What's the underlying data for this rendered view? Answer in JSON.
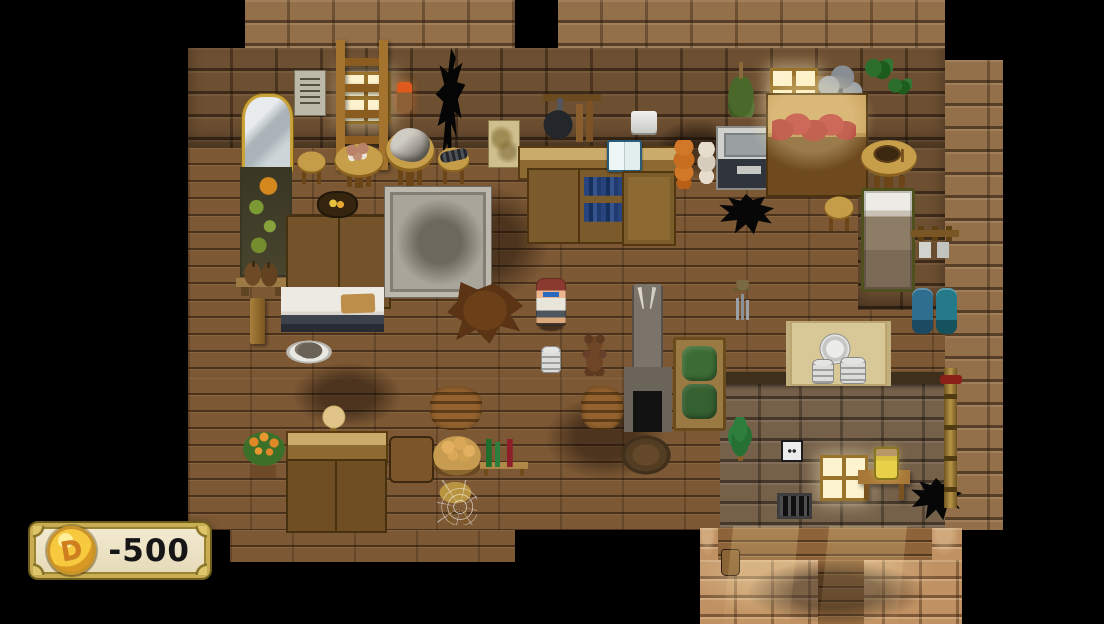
{
  "hud": {
    "gold_counter": {
      "value": "-500",
      "coin_icon": "gold-coin-icon",
      "coin_symbol": "D",
      "colors": {
        "panel": "#ece3c6",
        "border_gold": "#c9ad52",
        "border_dark": "#6e5e1c",
        "coin": "#f6c93e",
        "text": "#161616"
      }
    }
  },
  "scene": {
    "background": "#000000",
    "palette": {
      "wall_brick": "#93704a",
      "wall_face": "#6d4f31",
      "stone_wall": "#75604a",
      "bright_brick": "#c09162",
      "floor_wood": "#7c5834",
      "walkway_wood": "#8d6339"
    },
    "regions": [
      {
        "name": "wall-top-left",
        "kind": "wall",
        "x": 245,
        "y": 0,
        "w": 270,
        "h": 50
      },
      {
        "name": "wall-top-right",
        "kind": "wall",
        "x": 558,
        "y": 0,
        "w": 387,
        "h": 50
      },
      {
        "name": "wall-face-band",
        "kind": "wallface",
        "x": 188,
        "y": 48,
        "w": 757,
        "h": 100
      },
      {
        "name": "wall-right-column",
        "kind": "wall",
        "x": 945,
        "y": 60,
        "w": 58,
        "h": 470
      },
      {
        "name": "floor-main",
        "kind": "floor",
        "x": 188,
        "y": 148,
        "w": 757,
        "h": 230
      },
      {
        "name": "floor-lower-left",
        "kind": "floor",
        "x": 188,
        "y": 378,
        "w": 532,
        "h": 152
      },
      {
        "name": "floor-bottom-strip",
        "kind": "floor",
        "x": 230,
        "y": 530,
        "w": 285,
        "h": 32
      },
      {
        "name": "bed-nook-wall",
        "kind": "wallface",
        "x": 858,
        "y": 148,
        "w": 87,
        "h": 162
      },
      {
        "name": "inner-room-wall",
        "kind": "stonewall",
        "x": 720,
        "y": 378,
        "w": 225,
        "h": 152
      },
      {
        "name": "inner-room-roof-edge",
        "kind": "roofedge",
        "x": 714,
        "y": 372,
        "w": 236,
        "h": 12
      },
      {
        "name": "walkway-horizontal",
        "kind": "walkway",
        "x": 718,
        "y": 528,
        "w": 214,
        "h": 32
      },
      {
        "name": "bright-floor",
        "kind": "bright",
        "x": 700,
        "y": 560,
        "w": 262,
        "h": 64
      },
      {
        "name": "bright-floor-right",
        "kind": "bright",
        "x": 932,
        "y": 528,
        "w": 30,
        "h": 32
      },
      {
        "name": "bright-floor-left",
        "kind": "bright",
        "x": 700,
        "y": 528,
        "w": 18,
        "h": 32
      },
      {
        "name": "walkway-vertical",
        "kind": "walkway",
        "x": 818,
        "y": 560,
        "w": 46,
        "h": 64
      }
    ],
    "objects": [
      {
        "name": "floor-stain-1",
        "kind": "stain",
        "x": 420,
        "y": 185,
        "w": 130,
        "h": 115
      },
      {
        "name": "floor-stain-2",
        "kind": "stain",
        "x": 545,
        "y": 395,
        "w": 120,
        "h": 85
      },
      {
        "name": "floor-stain-3",
        "kind": "stain",
        "x": 292,
        "y": 362,
        "w": 110,
        "h": 66
      },
      {
        "name": "floor-stain-4",
        "kind": "stain",
        "x": 745,
        "y": 560,
        "w": 180,
        "h": 64
      },
      {
        "name": "floor-stain-5",
        "kind": "stain",
        "x": 655,
        "y": 118,
        "w": 85,
        "h": 62
      },
      {
        "name": "mirror",
        "kind": "mirror",
        "x": 242,
        "y": 94,
        "w": 45,
        "h": 74
      },
      {
        "name": "notice-poster",
        "kind": "poster",
        "x": 294,
        "y": 70,
        "w": 30,
        "h": 44
      },
      {
        "name": "lit-window-left",
        "kind": "window",
        "x": 341,
        "y": 72,
        "w": 44,
        "h": 46
      },
      {
        "name": "ladder",
        "kind": "ladder",
        "x": 336,
        "y": 40,
        "w": 52,
        "h": 130
      },
      {
        "name": "wall-torch",
        "kind": "torch",
        "x": 397,
        "y": 82,
        "w": 15,
        "h": 30
      },
      {
        "name": "burnt-wall-crack",
        "kind": "crack",
        "x": 428,
        "y": 48,
        "w": 48,
        "h": 122
      },
      {
        "name": "stained-poster",
        "kind": "poster2",
        "x": 488,
        "y": 120,
        "w": 30,
        "h": 46
      },
      {
        "name": "pan-rack",
        "kind": "panrack",
        "x": 543,
        "y": 94,
        "w": 58,
        "h": 48
      },
      {
        "name": "paper-roll-holder",
        "kind": "roll",
        "x": 631,
        "y": 111,
        "w": 26,
        "h": 22
      },
      {
        "name": "dried-herb-bundle",
        "kind": "herbs",
        "x": 727,
        "y": 62,
        "w": 28,
        "h": 55
      },
      {
        "name": "lit-window-right",
        "kind": "window",
        "x": 770,
        "y": 68,
        "w": 42,
        "h": 34
      },
      {
        "name": "coal-pile",
        "kind": "coal",
        "x": 815,
        "y": 62,
        "w": 50,
        "h": 54
      },
      {
        "name": "vine-leaf-upper",
        "kind": "leaf",
        "x": 865,
        "y": 58,
        "w": 28,
        "h": 22
      },
      {
        "name": "vine-leaf-lower",
        "kind": "leaf",
        "x": 888,
        "y": 78,
        "w": 24,
        "h": 17
      },
      {
        "name": "fruit-panel",
        "kind": "mossy",
        "x": 240,
        "y": 167,
        "w": 48,
        "h": 106
      },
      {
        "name": "sack-shelf",
        "kind": "sackshelf",
        "x": 236,
        "y": 254,
        "w": 52,
        "h": 42
      },
      {
        "name": "wood-post",
        "kind": "post",
        "x": 250,
        "y": 298,
        "w": 15,
        "h": 46
      },
      {
        "name": "stool-left",
        "kind": "stool",
        "x": 295,
        "y": 150,
        "w": 33,
        "h": 34
      },
      {
        "name": "mushroom-table",
        "kind": "tablemush",
        "x": 334,
        "y": 142,
        "w": 50,
        "h": 46
      },
      {
        "name": "rock-table",
        "kind": "table",
        "x": 385,
        "y": 130,
        "w": 50,
        "h": 57
      },
      {
        "name": "table-rock",
        "kind": "rock",
        "x": 390,
        "y": 128,
        "w": 40,
        "h": 34
      },
      {
        "name": "centipede-stool",
        "kind": "stool",
        "x": 435,
        "y": 146,
        "w": 37,
        "h": 38
      },
      {
        "name": "centipede",
        "kind": "bug",
        "x": 440,
        "y": 150,
        "w": 28,
        "h": 11
      },
      {
        "name": "green-dish-cupboard",
        "kind": "cupgreen",
        "x": 286,
        "y": 215,
        "w": 51,
        "h": 90
      },
      {
        "name": "bread-cupboard",
        "kind": "cupbread",
        "x": 338,
        "y": 215,
        "w": 49,
        "h": 90
      },
      {
        "name": "fruit-plaque",
        "kind": "plaque",
        "x": 317,
        "y": 191,
        "w": 37,
        "h": 23
      },
      {
        "name": "stone-rug",
        "kind": "stonerug",
        "x": 385,
        "y": 187,
        "w": 96,
        "h": 100
      },
      {
        "name": "back-counter",
        "kind": "countertan",
        "x": 518,
        "y": 146,
        "w": 165,
        "h": 30
      },
      {
        "name": "canned-goods-shelf",
        "kind": "cans",
        "x": 527,
        "y": 168,
        "w": 56,
        "h": 72
      },
      {
        "name": "bookshelf",
        "kind": "books",
        "x": 578,
        "y": 168,
        "w": 55,
        "h": 72
      },
      {
        "name": "display-book",
        "kind": "openbook",
        "x": 607,
        "y": 140,
        "w": 31,
        "h": 28
      },
      {
        "name": "wardrobe",
        "kind": "wardrobe",
        "x": 622,
        "y": 171,
        "w": 50,
        "h": 71
      },
      {
        "name": "onion-string",
        "kind": "onions",
        "x": 672,
        "y": 140,
        "w": 24,
        "h": 49
      },
      {
        "name": "garlic-string",
        "kind": "garlic",
        "x": 696,
        "y": 142,
        "w": 21,
        "h": 44
      },
      {
        "name": "sink-unit",
        "kind": "sink",
        "x": 716,
        "y": 126,
        "w": 62,
        "h": 60
      },
      {
        "name": "sausage-counter",
        "kind": "counterwood",
        "x": 766,
        "y": 93,
        "w": 98,
        "h": 100
      },
      {
        "name": "sausage-links",
        "kind": "sausage",
        "x": 772,
        "y": 112,
        "w": 84,
        "h": 32
      },
      {
        "name": "floor-hole-kitchen",
        "kind": "hole",
        "x": 718,
        "y": 194,
        "w": 56,
        "h": 42
      },
      {
        "name": "bowl-table",
        "kind": "tablebowl",
        "x": 860,
        "y": 139,
        "w": 58,
        "h": 50
      },
      {
        "name": "bedroom-stool",
        "kind": "stool",
        "x": 822,
        "y": 195,
        "w": 34,
        "h": 36
      },
      {
        "name": "bed",
        "kind": "bed",
        "x": 861,
        "y": 188,
        "w": 48,
        "h": 98
      },
      {
        "name": "mug-rack",
        "kind": "mugrack",
        "x": 911,
        "y": 226,
        "w": 48,
        "h": 35
      },
      {
        "name": "bedroll-pair",
        "kind": "bluerolls",
        "x": 911,
        "y": 288,
        "w": 48,
        "h": 46
      },
      {
        "name": "bear-pelt-rug",
        "kind": "pelt",
        "x": 447,
        "y": 282,
        "w": 76,
        "h": 63
      },
      {
        "name": "white-counter",
        "kind": "whitecounter",
        "x": 281,
        "y": 287,
        "w": 103,
        "h": 45
      },
      {
        "name": "cutting-board",
        "kind": "cutboard",
        "x": 341,
        "y": 294,
        "w": 34,
        "h": 19
      },
      {
        "name": "food-plate",
        "kind": "foodplate",
        "x": 285,
        "y": 340,
        "w": 48,
        "h": 24
      },
      {
        "name": "player-shadow",
        "kind": "shadow",
        "x": 537,
        "y": 322,
        "w": 28,
        "h": 10
      },
      {
        "name": "player-character",
        "kind": "player",
        "x": 536,
        "y": 278,
        "w": 30,
        "h": 48
      },
      {
        "name": "plate-stack-floor",
        "kind": "plates",
        "x": 541,
        "y": 346,
        "w": 20,
        "h": 27
      },
      {
        "name": "teddy-bear-floor",
        "kind": "teddy",
        "x": 580,
        "y": 334,
        "w": 29,
        "h": 42
      },
      {
        "name": "fireplace",
        "kind": "fireplace",
        "x": 622,
        "y": 284,
        "w": 52,
        "h": 148
      },
      {
        "name": "firewood-mid",
        "kind": "woodpile",
        "x": 581,
        "y": 386,
        "w": 42,
        "h": 44
      },
      {
        "name": "green-couch",
        "kind": "couch",
        "x": 673,
        "y": 337,
        "w": 47,
        "h": 88
      },
      {
        "name": "wind-chime",
        "kind": "chime",
        "x": 729,
        "y": 280,
        "w": 27,
        "h": 40
      },
      {
        "name": "plate-mat",
        "kind": "mat",
        "x": 786,
        "y": 321,
        "w": 97,
        "h": 65
      },
      {
        "name": "mat-plate-large",
        "kind": "platebig",
        "x": 814,
        "y": 330,
        "w": 42,
        "h": 42
      },
      {
        "name": "mat-plate-left",
        "kind": "plates",
        "x": 812,
        "y": 359,
        "w": 22,
        "h": 25
      },
      {
        "name": "mat-plate-right",
        "kind": "plates",
        "x": 840,
        "y": 357,
        "w": 26,
        "h": 27
      },
      {
        "name": "flower-pot",
        "kind": "flowers",
        "x": 241,
        "y": 428,
        "w": 46,
        "h": 50
      },
      {
        "name": "hat-stand",
        "kind": "hatstand",
        "x": 312,
        "y": 405,
        "w": 42,
        "h": 46
      },
      {
        "name": "tan-counter",
        "kind": "countertan",
        "x": 286,
        "y": 431,
        "w": 98,
        "h": 30
      },
      {
        "name": "boot-shelf",
        "kind": "bootshelf",
        "x": 286,
        "y": 459,
        "w": 48,
        "h": 70
      },
      {
        "name": "teddy-shelf",
        "kind": "bearshelf",
        "x": 335,
        "y": 459,
        "w": 48,
        "h": 70
      },
      {
        "name": "water-barrel",
        "kind": "barrel",
        "x": 389,
        "y": 436,
        "w": 41,
        "h": 43
      },
      {
        "name": "firewood-left",
        "kind": "woodpile",
        "x": 430,
        "y": 386,
        "w": 52,
        "h": 44
      },
      {
        "name": "bread-basket",
        "kind": "basket",
        "x": 432,
        "y": 431,
        "w": 50,
        "h": 45
      },
      {
        "name": "wine-bench",
        "kind": "winebench",
        "x": 480,
        "y": 427,
        "w": 48,
        "h": 49
      },
      {
        "name": "cobweb-stool",
        "kind": "webstool",
        "x": 437,
        "y": 480,
        "w": 40,
        "h": 45
      },
      {
        "name": "cactus-plant",
        "kind": "cactus",
        "x": 727,
        "y": 417,
        "w": 26,
        "h": 44
      },
      {
        "name": "dirt-mound",
        "kind": "dirt",
        "x": 618,
        "y": 433,
        "w": 56,
        "h": 44
      },
      {
        "name": "power-outlet",
        "kind": "outlet",
        "x": 781,
        "y": 440,
        "w": 18,
        "h": 18
      },
      {
        "name": "glowing-window",
        "kind": "window",
        "x": 820,
        "y": 455,
        "w": 42,
        "h": 40
      },
      {
        "name": "vent-grate",
        "kind": "vent",
        "x": 777,
        "y": 493,
        "w": 29,
        "h": 20
      },
      {
        "name": "honey-table",
        "kind": "sidetable",
        "x": 858,
        "y": 466,
        "w": 52,
        "h": 34
      },
      {
        "name": "honey-jar",
        "kind": "jar",
        "x": 874,
        "y": 447,
        "w": 21,
        "h": 29
      },
      {
        "name": "floor-hole-bedroom",
        "kind": "hole",
        "x": 910,
        "y": 478,
        "w": 52,
        "h": 44
      },
      {
        "name": "wall-pipe",
        "kind": "pipe",
        "x": 944,
        "y": 368,
        "w": 13,
        "h": 140
      },
      {
        "name": "small-pot",
        "kind": "smallpot",
        "x": 721,
        "y": 549,
        "w": 17,
        "h": 25
      },
      {
        "name": "light-shaft-left",
        "kind": "light",
        "x": 728,
        "y": 526,
        "w": 66,
        "h": 98
      },
      {
        "name": "light-shaft-right",
        "kind": "light",
        "x": 824,
        "y": 526,
        "w": 78,
        "h": 98
      },
      {
        "name": "window-light-glow",
        "kind": "glow",
        "x": 750,
        "y": 76,
        "w": 125,
        "h": 95
      }
    ]
  }
}
